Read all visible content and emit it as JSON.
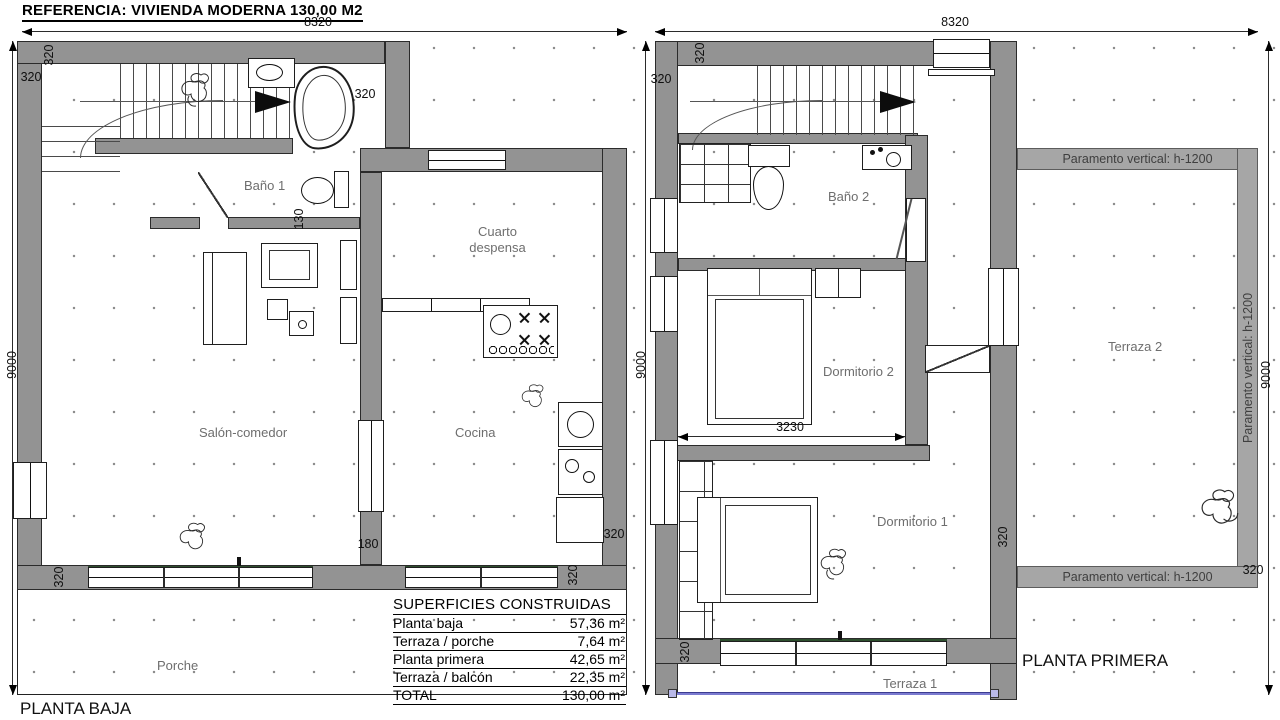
{
  "header": {
    "title": "REFERENCIA: VIVIENDA MODERNA 130,00 M2"
  },
  "dimensions": {
    "width_total": "8320",
    "depth_total": "9000",
    "wall": "320",
    "d180": "180",
    "d130": "130",
    "d3230": "3230"
  },
  "plan_baja": {
    "title": "PLANTA BAJA",
    "rooms": {
      "bano1": "Baño 1",
      "despensa_line1": "Cuarto",
      "despensa_line2": "despensa",
      "salon": "Salón-comedor",
      "cocina": "Cocina",
      "porche": "Porche"
    }
  },
  "plan_primera": {
    "title": "PLANTA PRIMERA",
    "rooms": {
      "bano2": "Baño 2",
      "dorm2": "Dormitorio 2",
      "dorm1": "Dormitorio 1",
      "terraza2": "Terraza 2",
      "terraza1": "Terraza 1"
    },
    "paramento_label": "Paramento vertical: h-1200"
  },
  "areas_table": {
    "title": "SUPERFICIES CONSTRUIDAS",
    "rows": [
      {
        "label": "Planta baja",
        "value": "57,36 m²"
      },
      {
        "label": "Terraza / porche",
        "value": "7,64 m²"
      },
      {
        "label": "Planta primera",
        "value": "42,65 m²"
      },
      {
        "label": "Terraza / balcón",
        "value": "22,35 m²"
      },
      {
        "label": "TOTAL",
        "value": "130,00 m²"
      }
    ]
  },
  "colors": {
    "wall_fill": "#939393",
    "parapet_band": "#a6a6a6",
    "railing_blue": "#7b7bd0",
    "window_green": "#2e4f2e"
  }
}
